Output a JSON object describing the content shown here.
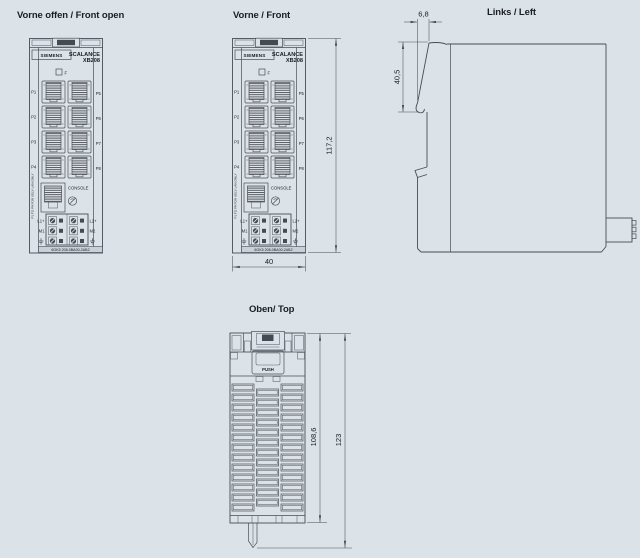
{
  "colors": {
    "background": "#dce3e8",
    "line": "#474d54",
    "dark_fill": "#454b51",
    "label_bar": "#c9d0d7",
    "text": "#1a1e23"
  },
  "views": {
    "front_open": {
      "title": "Vorne offen / Front open"
    },
    "front": {
      "title": "Vorne / Front"
    },
    "left": {
      "title": "Links / Left"
    },
    "top": {
      "title": "Oben/ Top"
    }
  },
  "device": {
    "brand": "SIEMENS",
    "product_line": "SCALANCE",
    "model": "XB208",
    "fault_led_label": "F",
    "port_labels_left": [
      "P1",
      "P2",
      "P3",
      "P4"
    ],
    "port_labels_right": [
      "P5",
      "P6",
      "P7",
      "P8"
    ],
    "console_label": "CONSOLE",
    "ports_note": "P1 TO P8 FOR SELV LAN ONLY",
    "power_terminal_labels_left": [
      "L1+",
      "M1"
    ],
    "power_terminal_labels_right": [
      "L2+",
      "M2"
    ],
    "ground_symbol": "earth-ground-icon",
    "article_number": "6GK5 208-0BA00-2AB2",
    "push_button_label": "PUSH"
  },
  "dimensions_mm": {
    "front_height": "117,2",
    "front_width": "40",
    "left_hinge_depth": "6,8",
    "left_front_panel_height": "40,5",
    "top_body_depth": "108,6",
    "top_total_depth": "123"
  }
}
